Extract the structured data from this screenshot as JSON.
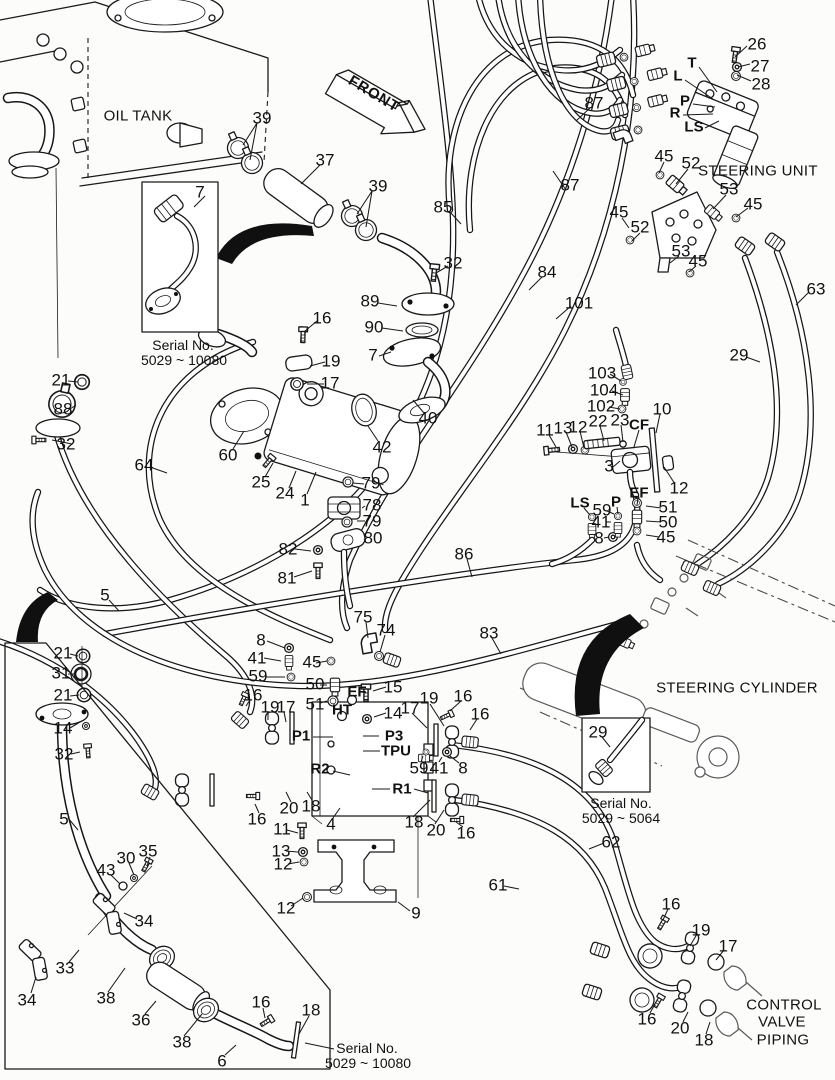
{
  "diagram": {
    "kind": "exploded-parts-diagram",
    "front_arrow": {
      "label": "FRONT"
    }
  },
  "labels": [
    {
      "t": "26",
      "x": 757,
      "y": 44
    },
    {
      "t": "27",
      "x": 760,
      "y": 66
    },
    {
      "t": "28",
      "x": 761,
      "y": 84
    },
    {
      "t": "T",
      "x": 692,
      "y": 63,
      "k": "port"
    },
    {
      "t": "L",
      "x": 678,
      "y": 76,
      "k": "port"
    },
    {
      "t": "P",
      "x": 685,
      "y": 101,
      "k": "port"
    },
    {
      "t": "R",
      "x": 675,
      "y": 113,
      "k": "port"
    },
    {
      "t": "LS",
      "x": 694,
      "y": 127,
      "k": "port"
    },
    {
      "t": "45",
      "x": 664,
      "y": 156
    },
    {
      "t": "52",
      "x": 691,
      "y": 163
    },
    {
      "t": "53",
      "x": 729,
      "y": 189
    },
    {
      "t": "45",
      "x": 753,
      "y": 204
    },
    {
      "t": "45",
      "x": 619,
      "y": 212
    },
    {
      "t": "52",
      "x": 640,
      "y": 227
    },
    {
      "t": "53",
      "x": 681,
      "y": 251
    },
    {
      "t": "45",
      "x": 698,
      "y": 261
    },
    {
      "t": "87",
      "x": 594,
      "y": 103
    },
    {
      "t": "87",
      "x": 570,
      "y": 185
    },
    {
      "t": "85",
      "x": 443,
      "y": 207
    },
    {
      "t": "84",
      "x": 547,
      "y": 272
    },
    {
      "t": "101",
      "x": 579,
      "y": 303
    },
    {
      "t": "63",
      "x": 816,
      "y": 289
    },
    {
      "t": "29",
      "x": 739,
      "y": 355
    },
    {
      "t": "39",
      "x": 262,
      "y": 118
    },
    {
      "t": "37",
      "x": 325,
      "y": 160
    },
    {
      "t": "39",
      "x": 378,
      "y": 186
    },
    {
      "t": "32",
      "x": 453,
      "y": 263
    },
    {
      "t": "89",
      "x": 370,
      "y": 301
    },
    {
      "t": "90",
      "x": 374,
      "y": 327
    },
    {
      "t": "16",
      "x": 322,
      "y": 318
    },
    {
      "t": "7",
      "x": 200,
      "y": 192
    },
    {
      "t": "7",
      "x": 373,
      "y": 355
    },
    {
      "t": "21",
      "x": 61,
      "y": 380
    },
    {
      "t": "88",
      "x": 63,
      "y": 409
    },
    {
      "t": "32",
      "x": 66,
      "y": 444
    },
    {
      "t": "64",
      "x": 144,
      "y": 465
    },
    {
      "t": "5",
      "x": 105,
      "y": 595
    },
    {
      "t": "19",
      "x": 331,
      "y": 361
    },
    {
      "t": "17",
      "x": 330,
      "y": 383
    },
    {
      "t": "40",
      "x": 428,
      "y": 418
    },
    {
      "t": "42",
      "x": 382,
      "y": 447
    },
    {
      "t": "60",
      "x": 228,
      "y": 455
    },
    {
      "t": "25",
      "x": 261,
      "y": 482
    },
    {
      "t": "24",
      "x": 285,
      "y": 493
    },
    {
      "t": "1",
      "x": 305,
      "y": 500
    },
    {
      "t": "79",
      "x": 371,
      "y": 483
    },
    {
      "t": "78",
      "x": 372,
      "y": 505
    },
    {
      "t": "79",
      "x": 372,
      "y": 521
    },
    {
      "t": "80",
      "x": 373,
      "y": 538
    },
    {
      "t": "82",
      "x": 288,
      "y": 549
    },
    {
      "t": "81",
      "x": 287,
      "y": 578
    },
    {
      "t": "103",
      "x": 602,
      "y": 373
    },
    {
      "t": "104",
      "x": 604,
      "y": 390
    },
    {
      "t": "102",
      "x": 601,
      "y": 406
    },
    {
      "t": "10",
      "x": 662,
      "y": 409
    },
    {
      "t": "11",
      "x": 545,
      "y": 430
    },
    {
      "t": "13",
      "x": 563,
      "y": 428
    },
    {
      "t": "12",
      "x": 578,
      "y": 427
    },
    {
      "t": "22",
      "x": 598,
      "y": 421
    },
    {
      "t": "23",
      "x": 620,
      "y": 420
    },
    {
      "t": "CF",
      "x": 639,
      "y": 425,
      "k": "port"
    },
    {
      "t": "3",
      "x": 609,
      "y": 466
    },
    {
      "t": "12",
      "x": 679,
      "y": 488
    },
    {
      "t": "LS",
      "x": 580,
      "y": 503,
      "k": "port"
    },
    {
      "t": "P",
      "x": 616,
      "y": 502,
      "k": "port"
    },
    {
      "t": "EF",
      "x": 639,
      "y": 493,
      "k": "port"
    },
    {
      "t": "59",
      "x": 602,
      "y": 510
    },
    {
      "t": "51",
      "x": 668,
      "y": 507
    },
    {
      "t": "41",
      "x": 601,
      "y": 522
    },
    {
      "t": "50",
      "x": 668,
      "y": 522
    },
    {
      "t": "8",
      "x": 599,
      "y": 538
    },
    {
      "t": "45",
      "x": 666,
      "y": 537
    },
    {
      "t": "86",
      "x": 464,
      "y": 554
    },
    {
      "t": "83",
      "x": 489,
      "y": 633
    },
    {
      "t": "75",
      "x": 363,
      "y": 617
    },
    {
      "t": "74",
      "x": 386,
      "y": 630
    },
    {
      "t": "8",
      "x": 261,
      "y": 640
    },
    {
      "t": "41",
      "x": 257,
      "y": 658
    },
    {
      "t": "59",
      "x": 258,
      "y": 676
    },
    {
      "t": "45",
      "x": 312,
      "y": 662
    },
    {
      "t": "50",
      "x": 315,
      "y": 684
    },
    {
      "t": "51",
      "x": 315,
      "y": 704
    },
    {
      "t": "EF",
      "x": 357,
      "y": 692,
      "k": "port"
    },
    {
      "t": "HT",
      "x": 342,
      "y": 710,
      "k": "port"
    },
    {
      "t": "15",
      "x": 393,
      "y": 687
    },
    {
      "t": "14",
      "x": 393,
      "y": 713
    },
    {
      "t": "16",
      "x": 253,
      "y": 695
    },
    {
      "t": "19",
      "x": 270,
      "y": 707
    },
    {
      "t": "17",
      "x": 286,
      "y": 707
    },
    {
      "t": "P1",
      "x": 301,
      "y": 736,
      "k": "port"
    },
    {
      "t": "P3",
      "x": 394,
      "y": 736,
      "k": "port"
    },
    {
      "t": "TPU",
      "x": 396,
      "y": 751,
      "k": "port"
    },
    {
      "t": "17",
      "x": 410,
      "y": 708
    },
    {
      "t": "19",
      "x": 429,
      "y": 698
    },
    {
      "t": "16",
      "x": 463,
      "y": 696
    },
    {
      "t": "16",
      "x": 480,
      "y": 714
    },
    {
      "t": "59",
      "x": 419,
      "y": 768
    },
    {
      "t": "41",
      "x": 439,
      "y": 768
    },
    {
      "t": "8",
      "x": 463,
      "y": 768
    },
    {
      "t": "R2",
      "x": 320,
      "y": 769,
      "k": "port"
    },
    {
      "t": "R1",
      "x": 402,
      "y": 789,
      "k": "port"
    },
    {
      "t": "20",
      "x": 289,
      "y": 808
    },
    {
      "t": "18",
      "x": 311,
      "y": 806
    },
    {
      "t": "16",
      "x": 257,
      "y": 819
    },
    {
      "t": "4",
      "x": 331,
      "y": 824
    },
    {
      "t": "11",
      "x": 282,
      "y": 829
    },
    {
      "t": "13",
      "x": 281,
      "y": 851
    },
    {
      "t": "12",
      "x": 283,
      "y": 864
    },
    {
      "t": "12",
      "x": 286,
      "y": 908
    },
    {
      "t": "9",
      "x": 416,
      "y": 913
    },
    {
      "t": "18",
      "x": 414,
      "y": 822
    },
    {
      "t": "20",
      "x": 436,
      "y": 830
    },
    {
      "t": "16",
      "x": 466,
      "y": 833
    },
    {
      "t": "21",
      "x": 63,
      "y": 653
    },
    {
      "t": "31",
      "x": 61,
      "y": 673
    },
    {
      "t": "21",
      "x": 63,
      "y": 695
    },
    {
      "t": "14",
      "x": 63,
      "y": 728
    },
    {
      "t": "32",
      "x": 64,
      "y": 754
    },
    {
      "t": "5",
      "x": 64,
      "y": 819
    },
    {
      "t": "35",
      "x": 148,
      "y": 851
    },
    {
      "t": "30",
      "x": 126,
      "y": 858
    },
    {
      "t": "43",
      "x": 106,
      "y": 870
    },
    {
      "t": "34",
      "x": 144,
      "y": 921
    },
    {
      "t": "33",
      "x": 65,
      "y": 968
    },
    {
      "t": "34",
      "x": 27,
      "y": 1000
    },
    {
      "t": "38",
      "x": 106,
      "y": 998
    },
    {
      "t": "36",
      "x": 141,
      "y": 1020
    },
    {
      "t": "38",
      "x": 182,
      "y": 1042
    },
    {
      "t": "6",
      "x": 222,
      "y": 1061
    },
    {
      "t": "16",
      "x": 261,
      "y": 1002
    },
    {
      "t": "18",
      "x": 311,
      "y": 1010
    },
    {
      "t": "62",
      "x": 611,
      "y": 842
    },
    {
      "t": "61",
      "x": 498,
      "y": 885
    },
    {
      "t": "29",
      "x": 598,
      "y": 732
    },
    {
      "t": "16",
      "x": 671,
      "y": 904
    },
    {
      "t": "19",
      "x": 701,
      "y": 930
    },
    {
      "t": "17",
      "x": 728,
      "y": 946
    },
    {
      "t": "16",
      "x": 647,
      "y": 1019
    },
    {
      "t": "20",
      "x": 680,
      "y": 1028
    },
    {
      "t": "18",
      "x": 704,
      "y": 1040
    },
    {
      "t": "OIL TANK",
      "x": 138,
      "y": 116,
      "k": "title"
    },
    {
      "t": "STEERING UNIT",
      "x": 758,
      "y": 171,
      "k": "title"
    },
    {
      "t": "STEERING CYLINDER",
      "x": 737,
      "y": 688,
      "k": "title"
    },
    {
      "t": "CONTROL",
      "x": 784,
      "y": 1005,
      "k": "title"
    },
    {
      "t": "VALVE",
      "x": 782,
      "y": 1022,
      "k": "title"
    },
    {
      "t": "PIPING",
      "x": 783,
      "y": 1040,
      "k": "title"
    },
    {
      "t": "Serial No.",
      "x": 183,
      "y": 345,
      "k": "cap"
    },
    {
      "t": "5029 ~ 10080",
      "x": 184,
      "y": 360,
      "k": "cap"
    },
    {
      "t": "Serial No.",
      "x": 621,
      "y": 803,
      "k": "cap"
    },
    {
      "t": "5029 ~ 5064",
      "x": 621,
      "y": 818,
      "k": "cap"
    },
    {
      "t": "Serial No.",
      "x": 367,
      "y": 1048,
      "k": "cap"
    },
    {
      "t": "5029 ~ 10080",
      "x": 368,
      "y": 1063,
      "k": "cap"
    }
  ]
}
